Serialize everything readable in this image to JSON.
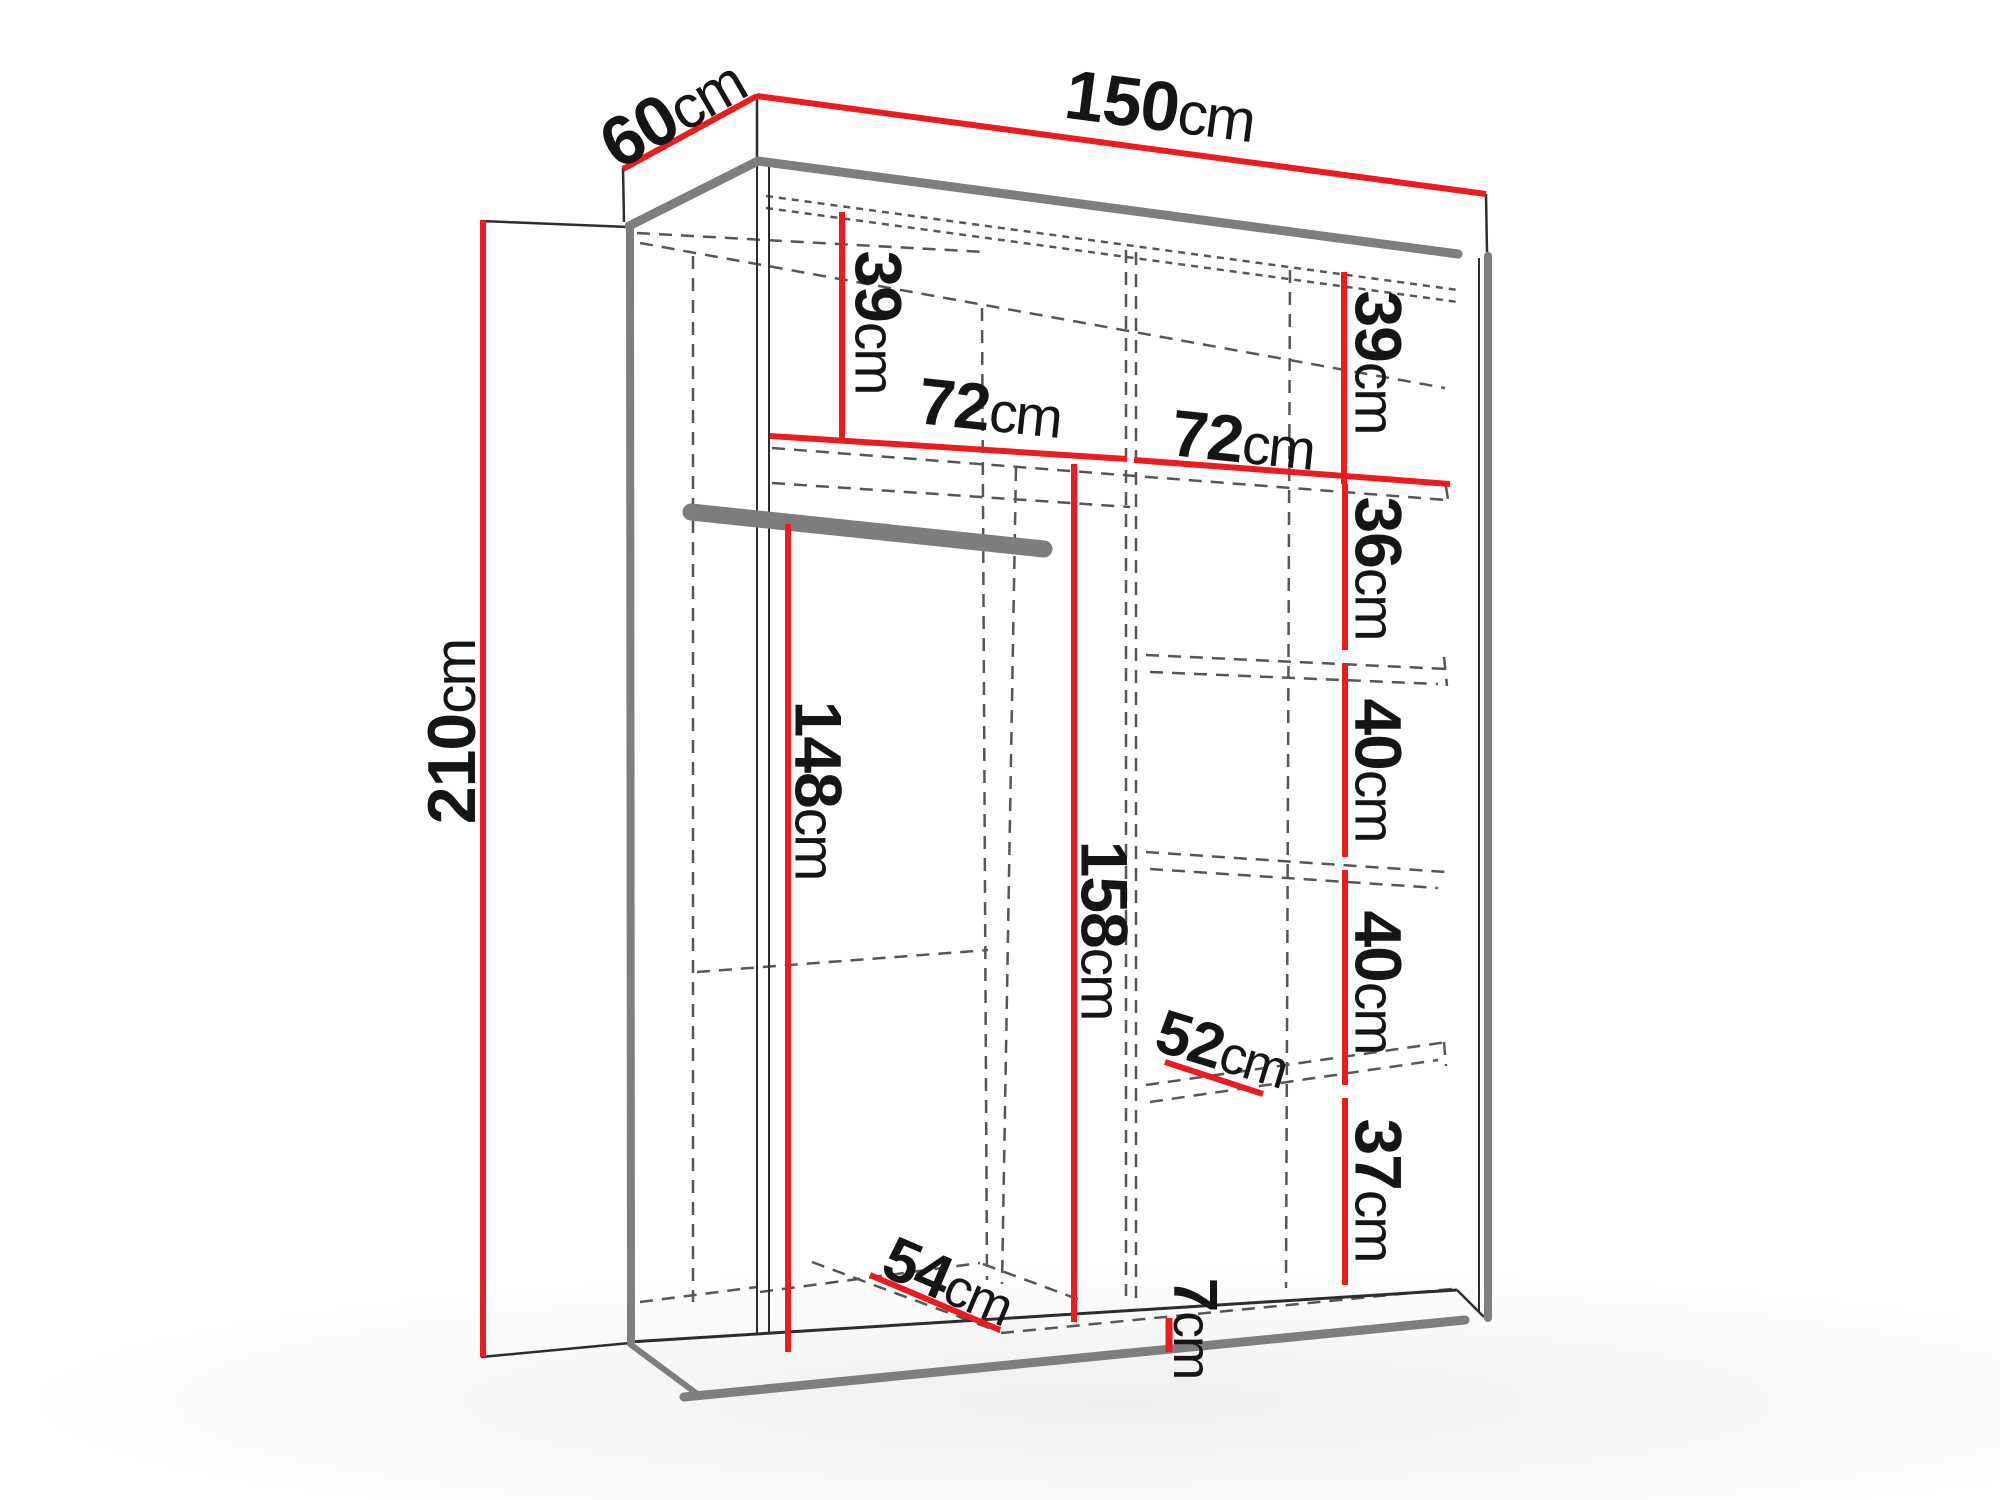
{
  "page": {
    "background": "#ffffff"
  },
  "diagram": {
    "kind": "wardrobe-interior-dimension-drawing",
    "unit": "cm",
    "accent_color": "#ea1c1f",
    "structure_color": "#7e7e7e",
    "hidden_line_color": "#565656",
    "labels": [
      {
        "value": "150",
        "unit": "cm",
        "role": "overall-width-top"
      },
      {
        "value": "60",
        "unit": "cm",
        "role": "overall-depth-top-left"
      },
      {
        "value": "210",
        "unit": "cm",
        "role": "overall-height-left"
      },
      {
        "value": "39",
        "unit": "cm",
        "role": "top-section-height-left"
      },
      {
        "value": "39",
        "unit": "cm",
        "role": "top-section-height-right"
      },
      {
        "value": "72",
        "unit": "cm",
        "role": "left-compartment-width"
      },
      {
        "value": "72",
        "unit": "cm",
        "role": "right-compartment-width"
      },
      {
        "value": "36",
        "unit": "cm",
        "role": "right-shelf-spacing-1"
      },
      {
        "value": "40",
        "unit": "cm",
        "role": "right-shelf-spacing-2"
      },
      {
        "value": "40",
        "unit": "cm",
        "role": "right-shelf-spacing-3"
      },
      {
        "value": "52",
        "unit": "cm",
        "role": "shelf-depth-right"
      },
      {
        "value": "37",
        "unit": "cm",
        "role": "right-shelf-spacing-4"
      },
      {
        "value": "7",
        "unit": "cm",
        "role": "plinth-height"
      },
      {
        "value": "148",
        "unit": "cm",
        "role": "hanging-space-height"
      },
      {
        "value": "158",
        "unit": "cm",
        "role": "left-compartment-height"
      },
      {
        "value": "54",
        "unit": "cm",
        "role": "bottom-interior-depth"
      }
    ]
  }
}
